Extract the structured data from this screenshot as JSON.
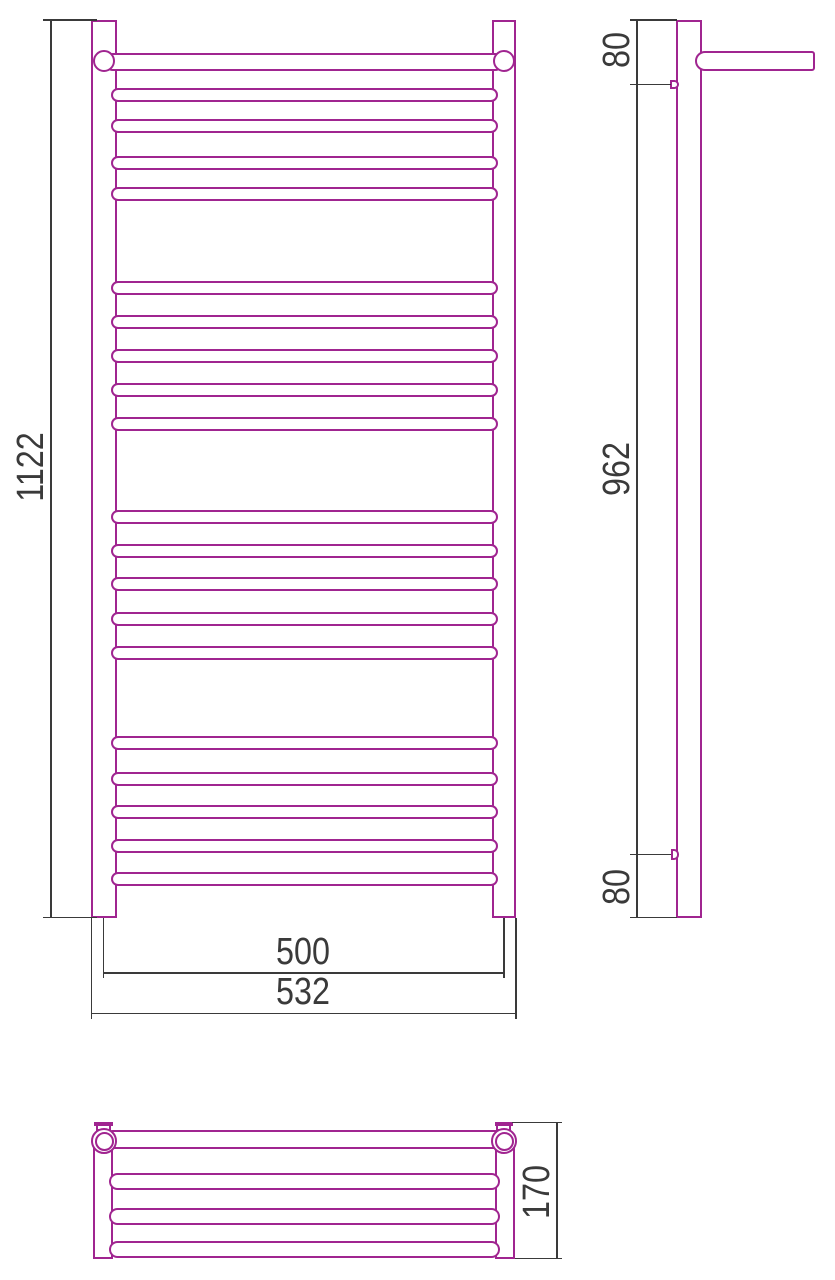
{
  "labels": {
    "overall_height": "1122",
    "rail_center_width": "500",
    "overall_width": "532",
    "side_top_offset": "80",
    "bracket_span": "962",
    "side_bottom_offset": "80",
    "shelf_depth": "170"
  },
  "colors": {
    "outline": "#A02590",
    "dimension": "#3A3A3A",
    "background": "#FFFFFF"
  },
  "geometry": {
    "front_rungs": {
      "x": 110.5,
      "width": 387,
      "height": 14,
      "tops": [
        88,
        119,
        156,
        187,
        281,
        315,
        349,
        383,
        417,
        510,
        544,
        577,
        612,
        646,
        736,
        772,
        805,
        839,
        872
      ]
    },
    "top_rungs": {
      "x": 108.5,
      "width": 391,
      "height": 17,
      "tops": [
        1173.3,
        1208.2,
        1240.8
      ]
    }
  }
}
